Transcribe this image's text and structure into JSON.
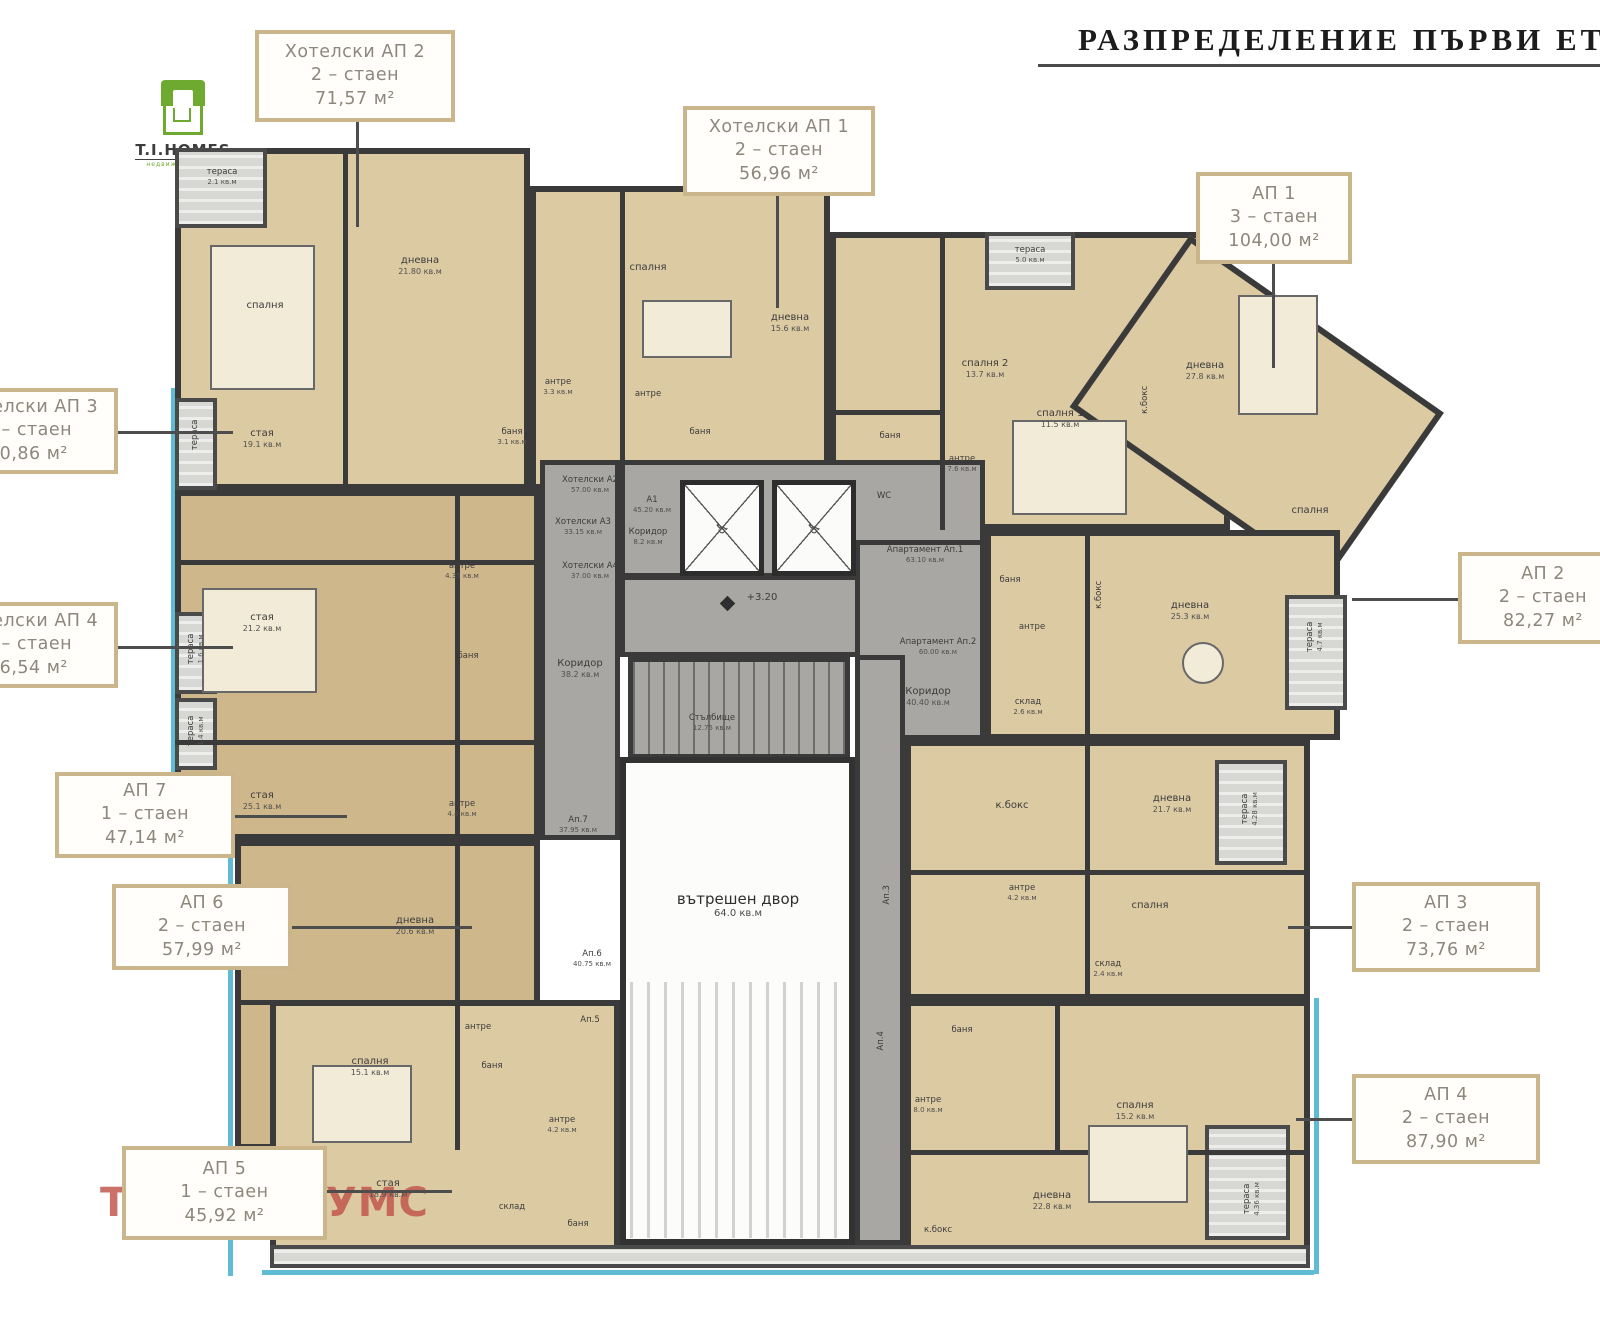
{
  "title": {
    "text": "РАЗПРЕДЕЛЕНИЕ ПЪРВИ ЕТАЖ"
  },
  "logo": {
    "name": "T.I.HOMES",
    "subtitle": "недвижими имоти"
  },
  "watermark": {
    "text": "ТИ АЙ ХОУМС"
  },
  "colors": {
    "wall": "#3a3a3a",
    "room_beige": "#dccaa3",
    "room_tan": "#cfb78c",
    "corridor": "#a8a7a3",
    "courtyard": "#fcfcfa",
    "terrace": "#d7d7d3",
    "accent_cyan": "#5fbcd3",
    "callout_border": "#cbb68b",
    "callout_text": "#8d877c",
    "watermark": "#c0524a",
    "logo_green": "#6faa30",
    "title": "#1c1c1c"
  },
  "plan": {
    "courtyard": {
      "label": "вътрешен двор",
      "area": "64.0 кв.м"
    },
    "level_mark": "+3.20",
    "rooms": [
      {
        "t": "тераса",
        "a": "2.1 кв.м",
        "x": 222,
        "y": 168,
        "s": 1
      },
      {
        "t": "спалня",
        "x": 265,
        "y": 300
      },
      {
        "t": "дневна",
        "a": "21.80 кв.м",
        "x": 420,
        "y": 255
      },
      {
        "t": "антре",
        "a": "3.3 кв.м",
        "x": 558,
        "y": 378,
        "s": 1
      },
      {
        "t": "баня",
        "a": "3.1 кв.м",
        "x": 512,
        "y": 428,
        "s": 1
      },
      {
        "t": "спалня",
        "x": 648,
        "y": 262
      },
      {
        "t": "дневна",
        "a": "15.6 кв.м",
        "x": 790,
        "y": 312
      },
      {
        "t": "антре",
        "x": 648,
        "y": 390,
        "s": 1
      },
      {
        "t": "баня",
        "x": 700,
        "y": 428,
        "s": 1
      },
      {
        "t": "тераса",
        "a": "5.0 кв.м",
        "x": 1030,
        "y": 246,
        "s": 1
      },
      {
        "t": "спалня 2",
        "a": "13.7 кв.м",
        "x": 985,
        "y": 358
      },
      {
        "t": "спалня 1",
        "a": "11.5 кв.м",
        "x": 1060,
        "y": 408
      },
      {
        "t": "дневна",
        "a": "27.8 кв.м",
        "x": 1205,
        "y": 360
      },
      {
        "t": "антре",
        "a": "7.6 кв.м",
        "x": 962,
        "y": 455,
        "s": 1
      },
      {
        "t": "баня",
        "x": 890,
        "y": 432,
        "s": 1
      },
      {
        "t": "WC",
        "x": 884,
        "y": 492,
        "s": 1
      },
      {
        "t": "к.бокс",
        "x": 1146,
        "y": 395,
        "v": 1,
        "s": 1
      },
      {
        "t": "спалня",
        "x": 1310,
        "y": 505
      },
      {
        "t": "Хотелски А2",
        "a": "57.00 кв.м",
        "x": 590,
        "y": 476,
        "s": 1
      },
      {
        "t": "Хотелски А3",
        "a": "33.15 кв.м",
        "x": 583,
        "y": 518,
        "s": 1
      },
      {
        "t": "Хотелски А4",
        "a": "37.00 кв.м",
        "x": 590,
        "y": 562,
        "s": 1
      },
      {
        "t": "А1",
        "a": "45.20 кв.м",
        "x": 652,
        "y": 496,
        "s": 1
      },
      {
        "t": "Коридор",
        "a": "8.2 кв.м",
        "x": 648,
        "y": 528,
        "s": 1
      },
      {
        "t": "Стълбище",
        "a": "12.75 кв.м",
        "x": 712,
        "y": 714,
        "s": 1
      },
      {
        "t": "Коридор",
        "a": "38.2 кв.м",
        "x": 580,
        "y": 658
      },
      {
        "t": "стая",
        "a": "19.1 кв.м",
        "x": 262,
        "y": 428
      },
      {
        "t": "стая",
        "a": "21.2 кв.м",
        "x": 262,
        "y": 612
      },
      {
        "t": "стая",
        "a": "25.1 кв.м",
        "x": 262,
        "y": 790
      },
      {
        "t": "антре",
        "a": "4.35 кв.м",
        "x": 462,
        "y": 562,
        "s": 1
      },
      {
        "t": "баня",
        "x": 468,
        "y": 652,
        "s": 1
      },
      {
        "t": "антре",
        "a": "4.4 кв.м",
        "x": 462,
        "y": 800,
        "s": 1
      },
      {
        "t": "Ап.7",
        "a": "37.95 кв.м",
        "x": 578,
        "y": 816,
        "s": 1
      },
      {
        "t": "Апартамент Ап.1",
        "a": "63.10 кв.м",
        "x": 925,
        "y": 546,
        "s": 1
      },
      {
        "t": "Апартамент Ап.2",
        "a": "60.00 кв.м",
        "x": 938,
        "y": 638,
        "s": 1
      },
      {
        "t": "Коридор",
        "a": "40.40 кв.м",
        "x": 928,
        "y": 686
      },
      {
        "t": "антре",
        "x": 1032,
        "y": 623,
        "s": 1
      },
      {
        "t": "склад",
        "a": "2.6 кв.м",
        "x": 1028,
        "y": 698,
        "s": 1
      },
      {
        "t": "баня",
        "x": 1010,
        "y": 576,
        "s": 1
      },
      {
        "t": "к.бокс",
        "x": 1100,
        "y": 590,
        "v": 1,
        "s": 1
      },
      {
        "t": "дневна",
        "a": "25.3 кв.м",
        "x": 1190,
        "y": 600
      },
      {
        "t": "тераса",
        "a": "4.7 кв.м",
        "x": 1315,
        "y": 628,
        "v": 1,
        "s": 1
      },
      {
        "t": "дневна",
        "a": "20.6 кв.м",
        "x": 415,
        "y": 915
      },
      {
        "t": "спалня",
        "a": "15.1 кв.м",
        "x": 370,
        "y": 1056
      },
      {
        "t": "антре",
        "x": 478,
        "y": 1023,
        "s": 1
      },
      {
        "t": "баня",
        "x": 492,
        "y": 1062,
        "s": 1
      },
      {
        "t": "Ап.6",
        "a": "40.75 кв.м",
        "x": 592,
        "y": 950,
        "s": 1
      },
      {
        "t": "Ап.5",
        "x": 590,
        "y": 1016,
        "s": 1
      },
      {
        "t": "антре",
        "a": "4.2 кв.м",
        "x": 562,
        "y": 1116,
        "s": 1
      },
      {
        "t": "стая",
        "a": "18.9 кв.м",
        "x": 388,
        "y": 1178
      },
      {
        "t": "склад",
        "x": 512,
        "y": 1203,
        "s": 1
      },
      {
        "t": "баня",
        "x": 578,
        "y": 1220,
        "s": 1
      },
      {
        "t": "к.бокс",
        "x": 1012,
        "y": 800
      },
      {
        "t": "дневна",
        "a": "21.7 кв.м",
        "x": 1172,
        "y": 793
      },
      {
        "t": "тераса",
        "a": "4.28 кв.м",
        "x": 1250,
        "y": 800,
        "v": 1,
        "s": 1
      },
      {
        "t": "антре",
        "a": "4.2 кв.м",
        "x": 1022,
        "y": 884,
        "s": 1
      },
      {
        "t": "спалня",
        "x": 1150,
        "y": 900
      },
      {
        "t": "склад",
        "a": "2.4 кв.м",
        "x": 1108,
        "y": 960,
        "s": 1
      },
      {
        "t": "баня",
        "x": 962,
        "y": 1026,
        "s": 1
      },
      {
        "t": "Ап.3",
        "x": 888,
        "y": 890,
        "v": 1,
        "s": 1
      },
      {
        "t": "Ап.4",
        "x": 882,
        "y": 1036,
        "v": 1,
        "s": 1
      },
      {
        "t": "спалня",
        "a": "15.2 кв.м",
        "x": 1135,
        "y": 1100
      },
      {
        "t": "антре",
        "a": "8.0 кв.м",
        "x": 928,
        "y": 1096,
        "s": 1
      },
      {
        "t": "дневна",
        "a": "22.8 кв.м",
        "x": 1052,
        "y": 1190
      },
      {
        "t": "к.бокс",
        "x": 938,
        "y": 1226,
        "s": 1
      },
      {
        "t": "тераса",
        "a": "4.36 кв.м",
        "x": 1252,
        "y": 1190,
        "v": 1,
        "s": 1
      },
      {
        "t": "тераса",
        "x": 196,
        "y": 430,
        "v": 1,
        "s": 1
      },
      {
        "t": "тераса",
        "a": "1.6 кв.м",
        "x": 196,
        "y": 640,
        "v": 1,
        "s": 1
      },
      {
        "t": "тераса",
        "a": "1.4 кв.м",
        "x": 196,
        "y": 722,
        "v": 1,
        "s": 1
      }
    ]
  },
  "callouts": [
    {
      "id": "hotel-ap2",
      "lines": [
        "Хотелски АП 2",
        "2 – стаен",
        "71,57 м²"
      ],
      "box": {
        "x": 255,
        "y": 30,
        "w": 200,
        "h": 92
      },
      "leader": {
        "x": 356,
        "y": 122,
        "w": 3,
        "h": 105
      }
    },
    {
      "id": "hotel-ap1",
      "lines": [
        "Хотелски АП 1",
        "2 – стаен",
        "56,96 м²"
      ],
      "box": {
        "x": 683,
        "y": 106,
        "w": 192,
        "h": 90
      },
      "leader": {
        "x": 776,
        "y": 196,
        "w": 3,
        "h": 112
      }
    },
    {
      "id": "ap1",
      "lines": [
        "АП 1",
        "3 – стаен",
        "104,00 м²"
      ],
      "box": {
        "x": 1196,
        "y": 172,
        "w": 156,
        "h": 92
      },
      "leader": {
        "x": 1272,
        "y": 264,
        "w": 3,
        "h": 104
      }
    },
    {
      "id": "hotel-ap3",
      "lines": [
        "Хотелски АП 3",
        "1 – стаен",
        "40,86 м²"
      ],
      "box": {
        "x": -62,
        "y": 388,
        "w": 180,
        "h": 86
      },
      "leader": {
        "x": 118,
        "y": 431,
        "w": 115,
        "h": 3
      }
    },
    {
      "id": "hotel-ap4",
      "lines": [
        "Хотелски АП 4",
        "1 – стаен",
        "46,54 м²"
      ],
      "box": {
        "x": -62,
        "y": 602,
        "w": 180,
        "h": 86
      },
      "leader": {
        "x": 118,
        "y": 646,
        "w": 115,
        "h": 3
      }
    },
    {
      "id": "ap2",
      "lines": [
        "АП 2",
        "2 – стаен",
        "82,27 м²"
      ],
      "box": {
        "x": 1458,
        "y": 552,
        "w": 170,
        "h": 92
      },
      "leader": {
        "x": 1352,
        "y": 598,
        "w": 106,
        "h": 3
      }
    },
    {
      "id": "ap7",
      "lines": [
        "АП 7",
        "1 – стаен",
        "47,14 м²"
      ],
      "box": {
        "x": 55,
        "y": 772,
        "w": 180,
        "h": 86
      },
      "leader": {
        "x": 235,
        "y": 815,
        "w": 112,
        "h": 3
      }
    },
    {
      "id": "ap6",
      "lines": [
        "АП 6",
        "2 – стаен",
        "57,99 м²"
      ],
      "box": {
        "x": 112,
        "y": 884,
        "w": 180,
        "h": 86
      },
      "leader": {
        "x": 292,
        "y": 926,
        "w": 180,
        "h": 3
      }
    },
    {
      "id": "ap3",
      "lines": [
        "АП 3",
        "2 – стаен",
        "73,76 м²"
      ],
      "box": {
        "x": 1352,
        "y": 882,
        "w": 188,
        "h": 90
      },
      "leader": {
        "x": 1288,
        "y": 926,
        "w": 64,
        "h": 3
      }
    },
    {
      "id": "ap4",
      "lines": [
        "АП 4",
        "2 – стаен",
        "87,90 м²"
      ],
      "box": {
        "x": 1352,
        "y": 1074,
        "w": 188,
        "h": 90
      },
      "leader": {
        "x": 1296,
        "y": 1118,
        "w": 56,
        "h": 3
      }
    },
    {
      "id": "ap5",
      "lines": [
        "АП 5",
        "1 – стаен",
        "45,92 м²"
      ],
      "box": {
        "x": 122,
        "y": 1146,
        "w": 205,
        "h": 94
      },
      "leader": {
        "x": 327,
        "y": 1190,
        "w": 125,
        "h": 3
      }
    }
  ]
}
